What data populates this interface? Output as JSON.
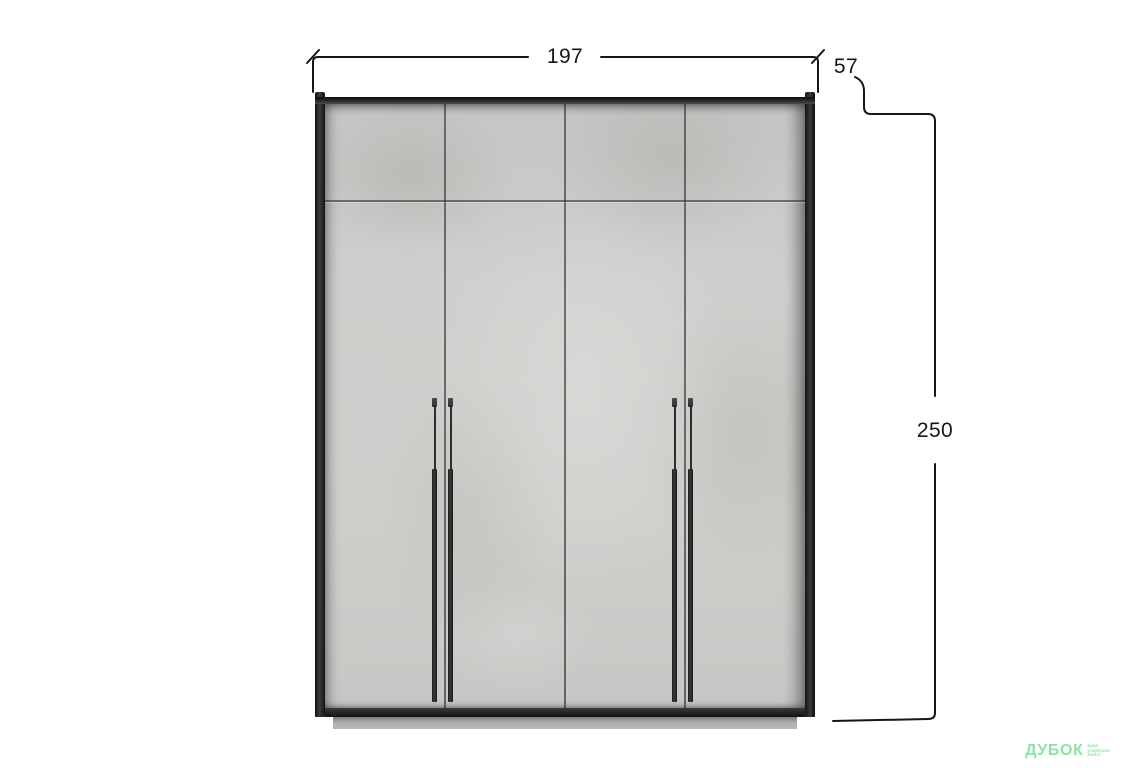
{
  "dimensions": {
    "width": "197",
    "depth": "57",
    "height": "250"
  },
  "watermark": {
    "brand": "ДУБОК",
    "tagline_line1": "ваші",
    "tagline_line2": "улюблені",
    "tagline_line3": "меблі"
  },
  "colors": {
    "annotation_line": "#161616",
    "watermark_green": "#8ee3a7",
    "door_face": "#cdccca",
    "frame_dark": "#1c1c1c",
    "plinth_gray": "#b3b2b0"
  }
}
